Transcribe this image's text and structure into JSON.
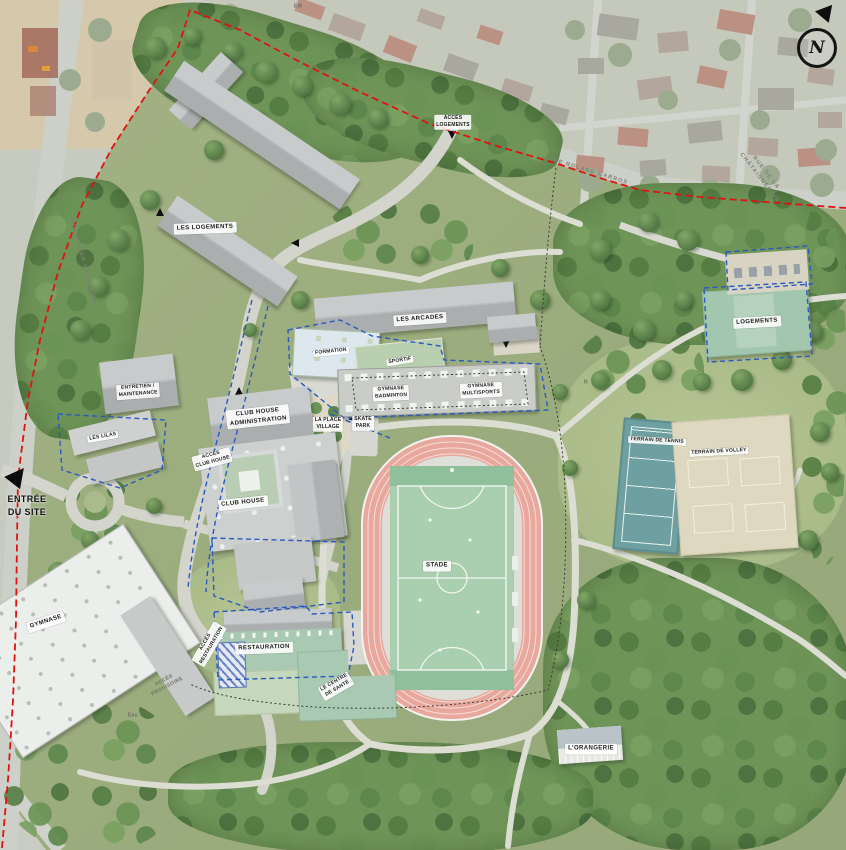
{
  "compass": {
    "letter": "N"
  },
  "areas": {
    "lesLogements": "LES LOGEMENTS",
    "lesArcades": "LES ARCADES",
    "formation": "FORMATION",
    "sportif": "SPORTIF",
    "gymnaseBadminton": "GYMNASE\nBADMINTON",
    "gymnaseMultisports": "GYMNASE\nMULTISPORTS",
    "clubHouseAdministration": "CLUB HOUSE\nADMINISTRATION",
    "clubHouse": "CLUB HOUSE",
    "entretienMaintenance": "ENTRETIEN /\nMAINTENANCE",
    "lesLilas": "LES LILAS",
    "laPlaceVillage": "LA PLACE\nVILLAGE",
    "skatePark": "SKATE\nPARK",
    "stade": "STADE",
    "terrainTennis": "TERRAIN DE TENNIS",
    "terrainVolley": "TERRAIN DE VOLLEY",
    "logements": "LOGEMENTS",
    "gymnase": "GYMNASE",
    "restauration": "RESTAURATION",
    "centreSante": "LE CENTRE\nDE SANTÉ",
    "orangerie": "L'ORANGERIE"
  },
  "access": {
    "entreeDuSite": "ENTRÉE\nDU SITE",
    "accesLogements": "ACCÈS\nLOGEMENTS",
    "accesClubHouse": "ACCÈS\nCLUB HOUSE",
    "accesRestauration": "ACCÈS\nRESTAURATION",
    "accesProvisoire": "ACCÈS\nPROVISOIRE"
  },
  "streets": {
    "top": "RUE ROLAND GARROS",
    "left": "RUE ROGER SALENGRO",
    "right": "RUE DE LA CHÂTAIGNERAIE"
  },
  "annotations": {
    "em": "EM",
    "eau": "Eau",
    "n": "N"
  },
  "colors": {
    "boundary": "#e01212",
    "route": "#2b59c3",
    "track": "#e8a89d",
    "pitch": "#aacfb0",
    "greenRoof": "#a9c9b3"
  }
}
